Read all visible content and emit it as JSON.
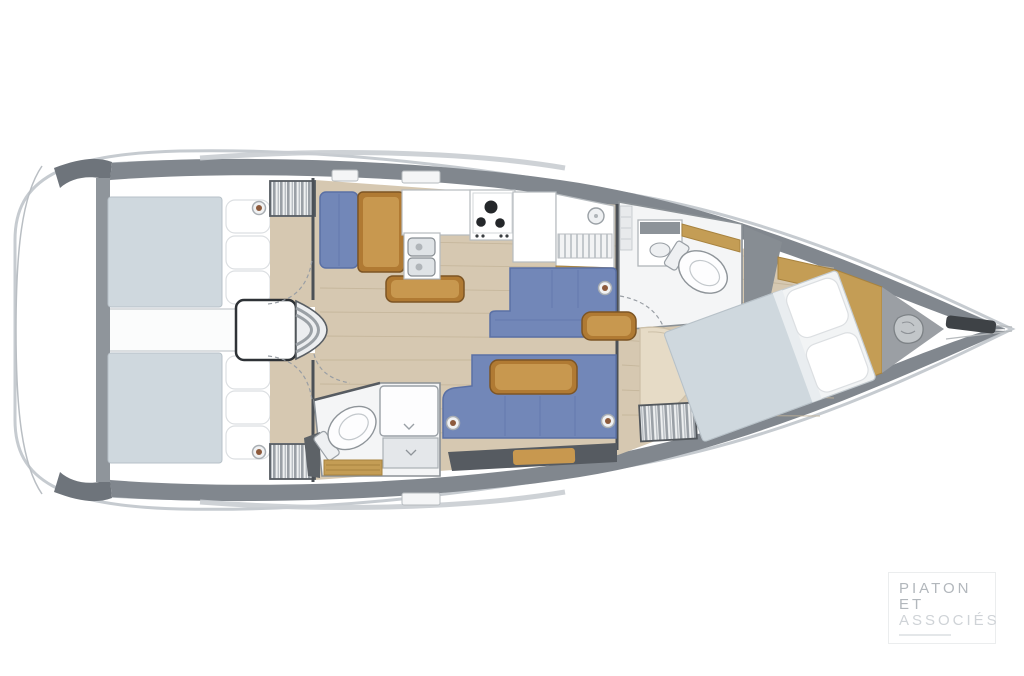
{
  "logo": {
    "line1": "PIATON",
    "line2": "ET",
    "line3": "ASSOCIÉS"
  },
  "palette": {
    "hull_outline": "#c6cbd0",
    "deck_gray": "#81878e",
    "dark_gray": "#565b61",
    "floor_tan": "#d6c8b1",
    "floor_line": "#c3b499",
    "wood": "#b07a33",
    "wood_light": "#c8984f",
    "gold_panel": "#c49d55",
    "upholstery_blue": "#7287b8",
    "upholstery_blue_dark": "#5a70a5",
    "bed_gray": "#cfd8de",
    "porthole_brown": "#8d5a3c",
    "logo_text": "#b2b7bc",
    "logo_text_light": "#cfd3d7"
  }
}
